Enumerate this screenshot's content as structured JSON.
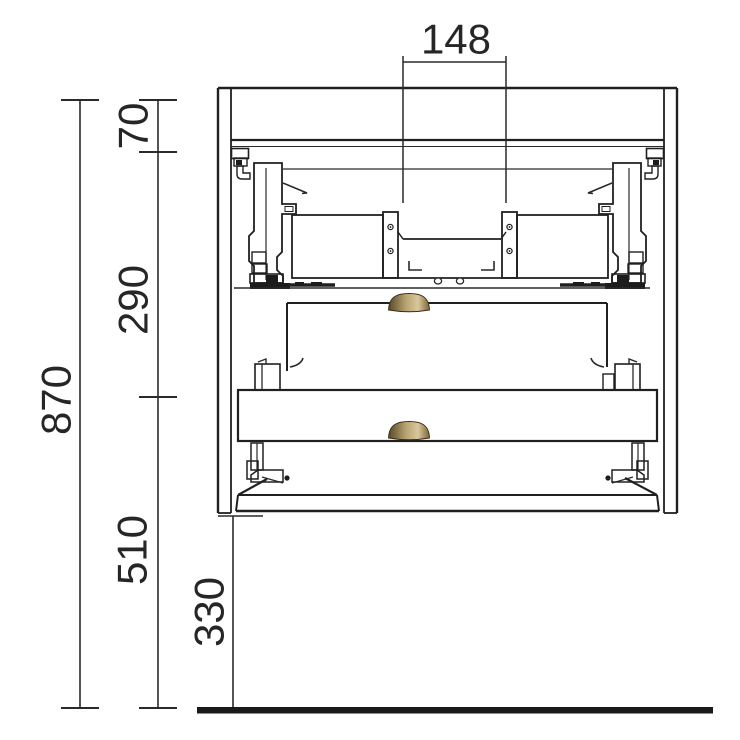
{
  "drawing": {
    "dims": {
      "recess_width": "148",
      "top_section": "70",
      "upper_section": "290",
      "lower_section": "510",
      "overall_height": "870",
      "floor_clearance": "330"
    },
    "colors": {
      "line": "#202020",
      "floor": "#1a1a1a",
      "handle_dark": "#574826",
      "handle_mid": "#b9a271",
      "handle_light": "#d8c79d",
      "handle_edge": "#7a6639"
    }
  }
}
